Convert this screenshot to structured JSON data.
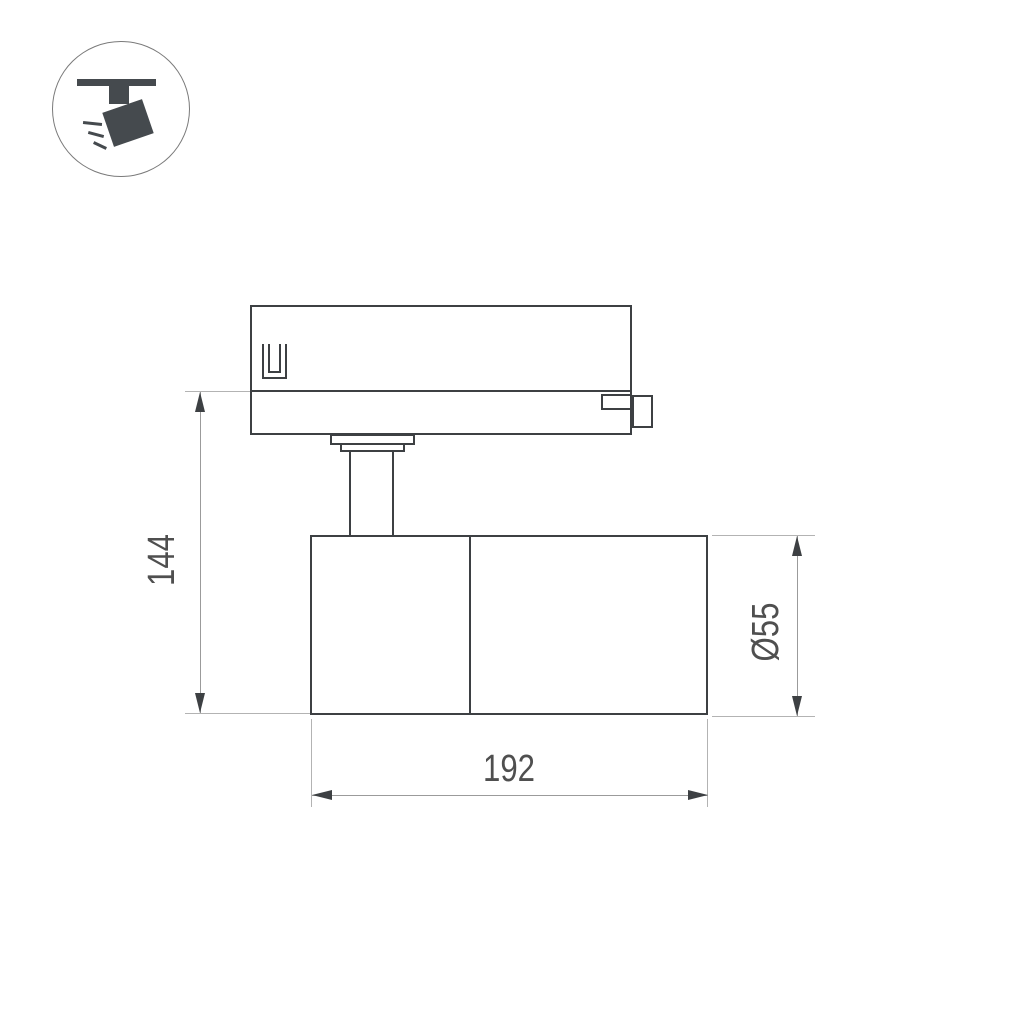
{
  "icon": {
    "name": "ceiling-track-spotlight-icon",
    "color": "#454a4e"
  },
  "drawing": {
    "colors": {
      "background": "#ffffff",
      "outline": "#3d4043",
      "dimension_line": "#9b9b9b",
      "extension_line": "#b3b3b3",
      "text": "#4f4f4f"
    },
    "dimensions": {
      "height": {
        "label": "144"
      },
      "length": {
        "label": "192"
      },
      "diameter": {
        "label": "Ø55"
      }
    }
  }
}
